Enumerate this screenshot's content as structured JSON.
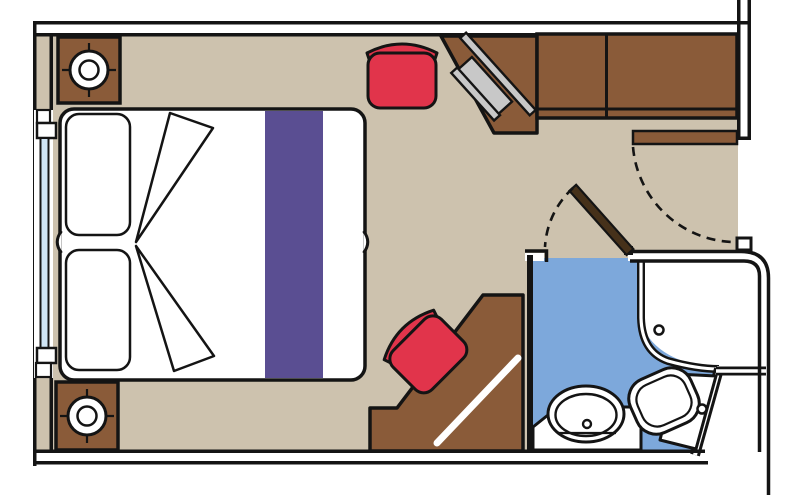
{
  "palette": {
    "floor": "#cdc2ae",
    "wood": "#8a5b39",
    "wood_dark": "#46311a",
    "red": "#e1344b",
    "purple": "#5a4e92",
    "bath_blue": "#7da8db",
    "glass": "#cfe4f4",
    "tv_gray": "#c8c8c8",
    "line": "#141414",
    "white": "#ffffff"
  },
  "elements": [
    "cabin-walls",
    "balcony-window",
    "double-bed",
    "pillows",
    "duvet-folds",
    "bed-runner",
    "nightstand-top",
    "nightstand-bottom",
    "table-lamp-icon",
    "stool",
    "dressing-desk",
    "tv-panel",
    "wardrobe",
    "entry-door",
    "entry-door-swing-arc",
    "bathroom",
    "bathroom-door",
    "bathroom-door-swing-arc",
    "shower",
    "shower-drain",
    "washbasin",
    "vanity",
    "toilet",
    "sofa-chaise",
    "chair"
  ]
}
